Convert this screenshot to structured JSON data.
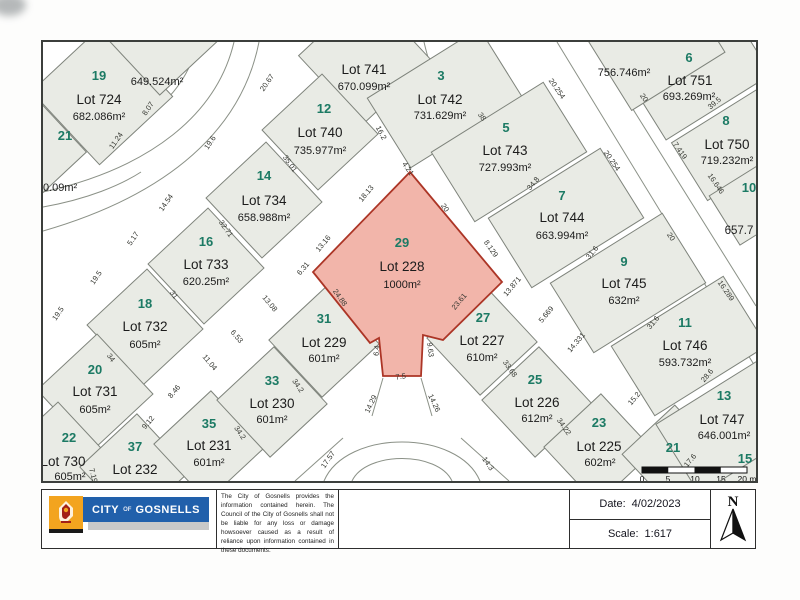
{
  "map": {
    "lots": [
      {
        "no": "19",
        "name": "Lot 724",
        "area": "682.086m²"
      },
      {
        "no": "21",
        "name": "",
        "area": ""
      },
      {
        "no": "",
        "name": "Lot 741",
        "area": "670.099m²"
      },
      {
        "no": "12",
        "name": "Lot 740",
        "area": "735.977m²"
      },
      {
        "no": "14",
        "name": "Lot 734",
        "area": "658.988m²"
      },
      {
        "no": "16",
        "name": "Lot 733",
        "area": "620.25m²"
      },
      {
        "no": "18",
        "name": "Lot 732",
        "area": "605m²"
      },
      {
        "no": "20",
        "name": "Lot 731",
        "area": "605m²"
      },
      {
        "no": "22",
        "name": "Lot 730",
        "area": "605m²"
      },
      {
        "no": "37",
        "name": "Lot 232",
        "area": "601m²"
      },
      {
        "no": "35",
        "name": "Lot 231",
        "area": "601m²"
      },
      {
        "no": "33",
        "name": "Lot 230",
        "area": "601m²"
      },
      {
        "no": "31",
        "name": "Lot 229",
        "area": "601m²"
      },
      {
        "no": "29",
        "name": "Lot 228",
        "area": "1000m²"
      },
      {
        "no": "27",
        "name": "Lot 227",
        "area": "610m²"
      },
      {
        "no": "25",
        "name": "Lot 226",
        "area": "612m²"
      },
      {
        "no": "23",
        "name": "Lot 225",
        "area": "602m²"
      },
      {
        "no": "21",
        "name": "",
        "area": ""
      },
      {
        "no": "15",
        "name": "",
        "area": ""
      },
      {
        "no": "3",
        "name": "Lot 742",
        "area": "731.629m²"
      },
      {
        "no": "5",
        "name": "Lot 743",
        "area": "727.993m²"
      },
      {
        "no": "7",
        "name": "Lot 744",
        "area": "663.994m²"
      },
      {
        "no": "9",
        "name": "Lot 745",
        "area": "632m²"
      },
      {
        "no": "11",
        "name": "Lot 746",
        "area": "593.732m²"
      },
      {
        "no": "13",
        "name": "Lot 747",
        "area": "646.001m²"
      },
      {
        "no": "6",
        "name": "Lot 751",
        "area": "693.269m²"
      },
      {
        "no": "8",
        "name": "Lot 750",
        "area": "719.232m²"
      },
      {
        "no": "10",
        "name": "",
        "area": ""
      }
    ],
    "extra_labels": [
      "649.524m²",
      "756.746m²",
      "30.09m²",
      "657.7"
    ],
    "dimensions": [
      {
        "v": "20.67",
        "x": 226,
        "y": 42,
        "r": -55
      },
      {
        "v": "8.07",
        "x": 107,
        "y": 68,
        "r": -55
      },
      {
        "v": "11.24",
        "x": 75,
        "y": 100,
        "r": -55
      },
      {
        "v": "19.6",
        "x": 169,
        "y": 102,
        "r": -55
      },
      {
        "v": "14.54",
        "x": 125,
        "y": 162,
        "r": -55
      },
      {
        "v": "5.17",
        "x": 92,
        "y": 198,
        "r": -55
      },
      {
        "v": "19.5",
        "x": 55,
        "y": 237,
        "r": -55
      },
      {
        "v": "19.5",
        "x": 17,
        "y": 273,
        "r": -55
      },
      {
        "v": "35.01",
        "x": 245,
        "y": 123,
        "r": 55
      },
      {
        "v": "32.71",
        "x": 181,
        "y": 188,
        "r": 55
      },
      {
        "v": "31",
        "x": 129,
        "y": 254,
        "r": 55
      },
      {
        "v": "34",
        "x": 66,
        "y": 317,
        "r": 55
      },
      {
        "v": "16.2",
        "x": 336,
        "y": 92,
        "r": 62
      },
      {
        "v": "4.21",
        "x": 363,
        "y": 128,
        "r": 55
      },
      {
        "v": "18.13",
        "x": 325,
        "y": 153,
        "r": -50
      },
      {
        "v": "13.16",
        "x": 282,
        "y": 203,
        "r": -50
      },
      {
        "v": "20",
        "x": 400,
        "y": 167,
        "r": 55
      },
      {
        "v": "8.129",
        "x": 446,
        "y": 208,
        "r": 55
      },
      {
        "v": "23.61",
        "x": 418,
        "y": 261,
        "r": -50
      },
      {
        "v": "24.88",
        "x": 295,
        "y": 257,
        "r": 55
      },
      {
        "v": "9.63",
        "x": 385,
        "y": 308,
        "r": 83
      },
      {
        "v": "6.4",
        "x": 336,
        "y": 309,
        "r": -83
      },
      {
        "v": "7.5",
        "x": 358,
        "y": 337,
        "r": -8
      },
      {
        "v": "6.31",
        "x": 262,
        "y": 228,
        "r": -50
      },
      {
        "v": "13.08",
        "x": 225,
        "y": 263,
        "r": 50
      },
      {
        "v": "6.53",
        "x": 192,
        "y": 296,
        "r": 50
      },
      {
        "v": "11.04",
        "x": 165,
        "y": 322,
        "r": 50
      },
      {
        "v": "8.46",
        "x": 133,
        "y": 351,
        "r": -50
      },
      {
        "v": "9.12",
        "x": 107,
        "y": 382,
        "r": -50
      },
      {
        "v": "7.19",
        "x": 48,
        "y": 434,
        "r": 75
      },
      {
        "v": "34.2",
        "x": 195,
        "y": 392,
        "r": 55
      },
      {
        "v": "34.2",
        "x": 253,
        "y": 345,
        "r": 55
      },
      {
        "v": "34.22",
        "x": 519,
        "y": 386,
        "r": 55
      },
      {
        "v": "33.68",
        "x": 465,
        "y": 328,
        "r": 55
      },
      {
        "v": "14.29",
        "x": 330,
        "y": 363,
        "r": -65
      },
      {
        "v": "14.26",
        "x": 389,
        "y": 362,
        "r": 65
      },
      {
        "v": "17.57",
        "x": 287,
        "y": 419,
        "r": -55
      },
      {
        "v": "14.3",
        "x": 443,
        "y": 423,
        "r": 55
      },
      {
        "v": "13.871",
        "x": 471,
        "y": 246,
        "r": -50
      },
      {
        "v": "5.669",
        "x": 505,
        "y": 274,
        "r": -50
      },
      {
        "v": "14.331",
        "x": 535,
        "y": 302,
        "r": -50
      },
      {
        "v": "15.2",
        "x": 593,
        "y": 358,
        "r": -50
      },
      {
        "v": "17.6",
        "x": 649,
        "y": 420,
        "r": -50
      },
      {
        "v": "34.8",
        "x": 492,
        "y": 143,
        "r": -50
      },
      {
        "v": "31.6",
        "x": 551,
        "y": 212,
        "r": -50
      },
      {
        "v": "31.6",
        "x": 612,
        "y": 282,
        "r": -50
      },
      {
        "v": "28.6",
        "x": 666,
        "y": 335,
        "r": -50
      },
      {
        "v": "38",
        "x": 437,
        "y": 76,
        "r": 55
      },
      {
        "v": "20",
        "x": 599,
        "y": 57,
        "r": 55
      },
      {
        "v": "20.254",
        "x": 512,
        "y": 48,
        "r": 55
      },
      {
        "v": "20.254",
        "x": 567,
        "y": 120,
        "r": 55
      },
      {
        "v": "7.419",
        "x": 635,
        "y": 110,
        "r": 55
      },
      {
        "v": "16.646",
        "x": 671,
        "y": 143,
        "r": 55
      },
      {
        "v": "39.5",
        "x": 673,
        "y": 63,
        "r": -40
      },
      {
        "v": "16.289",
        "x": 681,
        "y": 250,
        "r": 55
      },
      {
        "v": "20",
        "x": 626,
        "y": 196,
        "r": 55
      }
    ],
    "scale_bar": {
      "labels": [
        "0",
        "5",
        "10",
        "15",
        "20 m"
      ]
    }
  },
  "footer": {
    "logo": {
      "city": "CITY",
      "of": "OF",
      "name": "GOSNELLS"
    },
    "disclaimer": "The City of Gosnells provides the information contained herein. The Council of the City of Gosnells shall not be liable for any loss or damage howsoever caused as a result of reliance upon information contained in these documents.",
    "date_label": "Date:",
    "date_value": "4/02/2023",
    "scale_label": "Scale:",
    "scale_value": "1:617",
    "north_label": "N"
  },
  "colors": {
    "highlight_fill": "#f2b5aa",
    "highlight_stroke": "#ac3526",
    "street_number_green": "#1c7a64",
    "logo_blue": "#2160ab",
    "logo_orange": "#f3a41f",
    "parcel_fill": "#e9ebe5"
  }
}
